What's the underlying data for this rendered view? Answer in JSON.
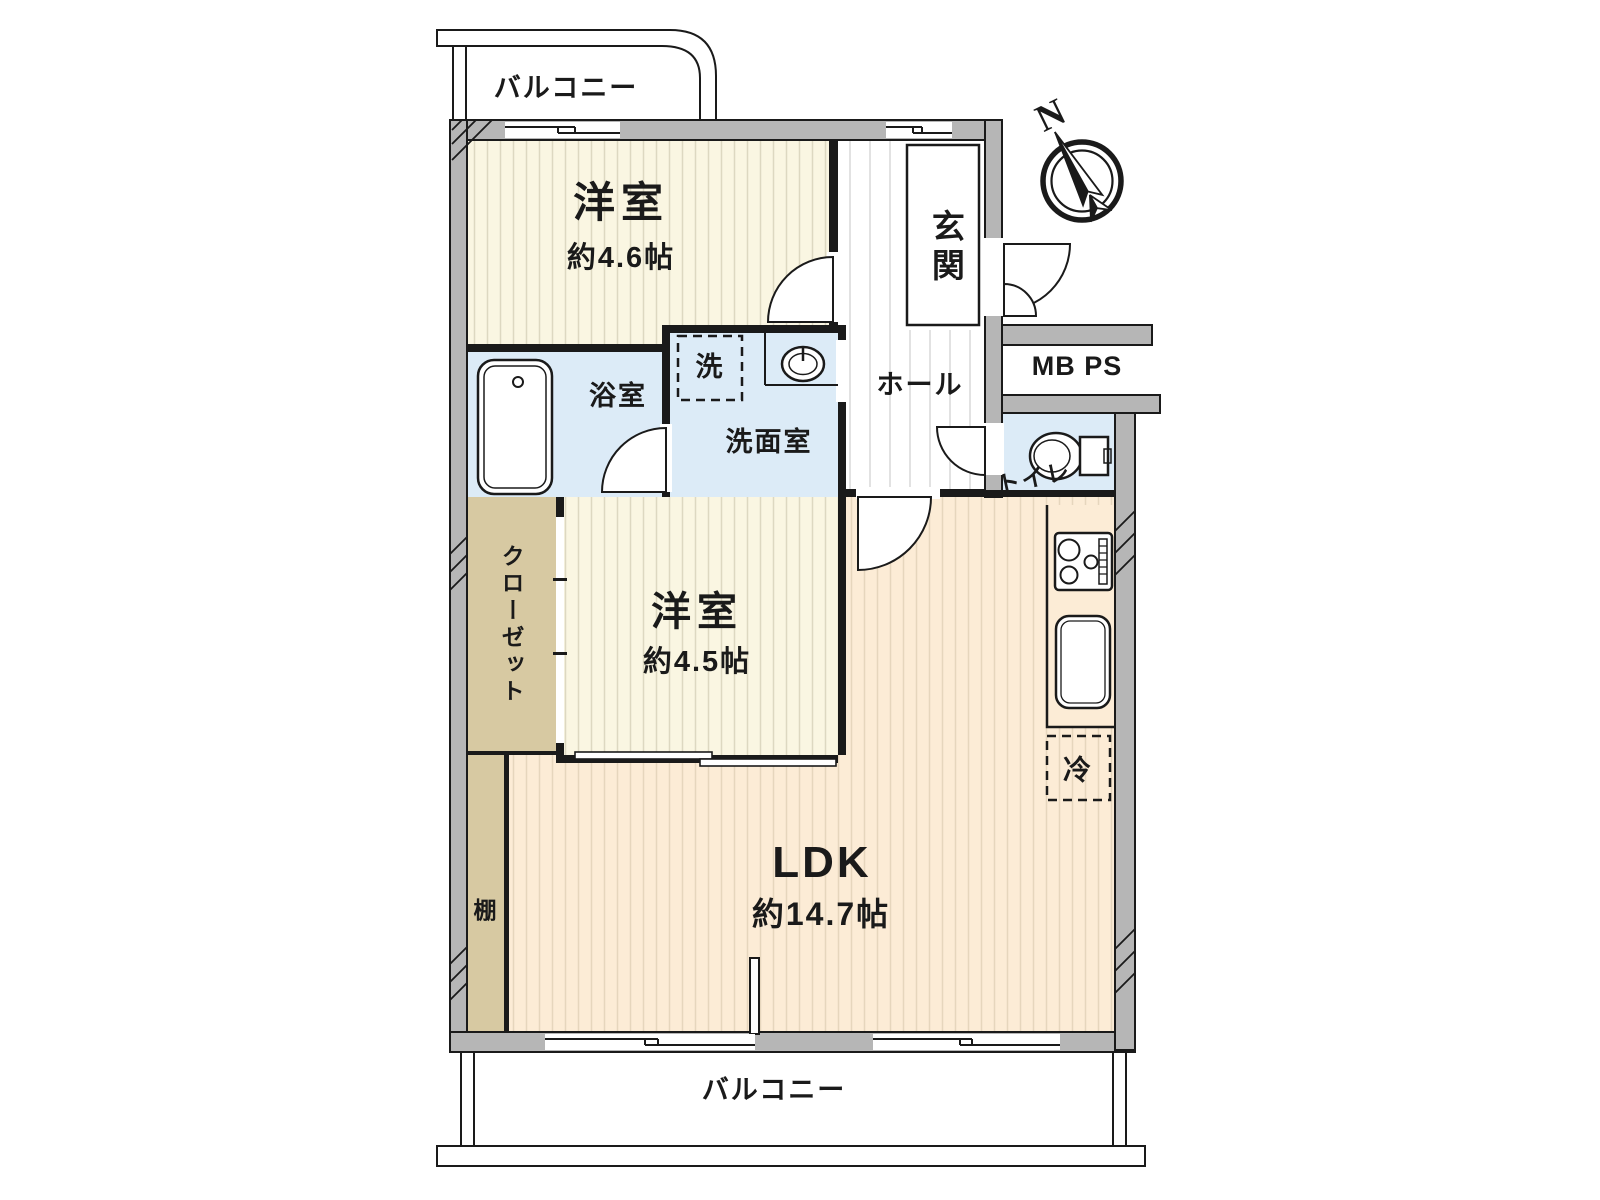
{
  "floorplan": {
    "balcony_top": "バルコニー",
    "balcony_bottom": "バルコニー",
    "western_room_1": {
      "name": "洋室",
      "area": "約4.6帖"
    },
    "western_room_2": {
      "name": "洋室",
      "area": "約4.5帖"
    },
    "ldk": {
      "name": "LDK",
      "area": "約14.7帖"
    },
    "entrance": "玄関",
    "hall": "ホール",
    "bathroom": "浴室",
    "washroom": "洗面室",
    "laundry": "洗",
    "toilet": "トイレ",
    "closet": "クローゼット",
    "shelf": "棚",
    "refrigerator": "冷",
    "meter_box_pipe_space": "MB PS",
    "compass_north": "N"
  },
  "colors": {
    "wall": "#b6b6b6",
    "outline": "#1a1a1a",
    "room_cream": "#faf6e2",
    "cream_stripe": "#ddd8c1",
    "ldk_peach": "#fcecd6",
    "ldk_stripe": "#e6d6bd",
    "wet_blue": "#dcebf7",
    "closet_tan": "#d7c9a2",
    "hall_stripe": "#d8d8d8"
  }
}
